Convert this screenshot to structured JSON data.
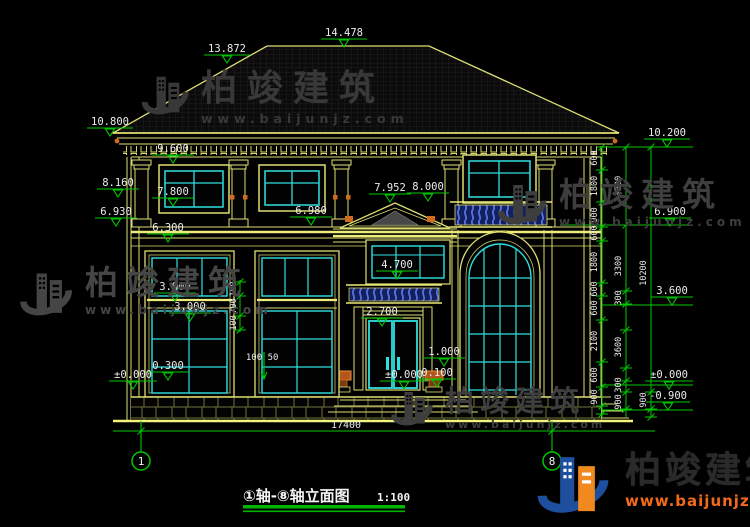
{
  "watermark": {
    "brand": "柏竣建筑",
    "url": "www.baijunjz.com"
  },
  "brand_logo": {
    "brand": "柏竣建筑",
    "url": "www.baijunjz.com"
  },
  "title_bar": {
    "title": "①轴-⑧轴立面图",
    "scale": "1:100"
  },
  "axes": {
    "left": "1",
    "right": "8"
  },
  "dims": {
    "total_width": "17400",
    "elevations": {
      "ridge": "14.478",
      "slope": "13.872",
      "eave": "10.800",
      "right_eave": "10.200",
      "win2_head": "9.600",
      "capital": "8.160",
      "balcony_rail": "8.000",
      "porch_ridge": "7.952",
      "win2_sill": "7.800",
      "eave_band_left": "6.930",
      "porch_eave": "6.980",
      "level2_right": "6.900",
      "floor_band": "6.300",
      "transom_head": "4.700",
      "win1_head": "3.900",
      "level1_right": "3.600",
      "transom_sill": "3.000",
      "door_head": "2.700",
      "planter": "1.000",
      "sill_ledge": "0.300",
      "entry_step": "0.100",
      "ground_left": "±0.000",
      "ground_entry": "±0.000",
      "ground_right": "±0.000",
      "footing": "-0.900"
    },
    "right_chain_inner": [
      "600",
      "1800",
      "900",
      "600",
      "1800",
      "600",
      "600",
      "2100",
      "600",
      "900"
    ],
    "right_chain_mid": [
      "3300",
      "3300",
      "300",
      "3600",
      "300",
      "900"
    ],
    "right_chain_outer": [
      "10200",
      "900"
    ],
    "pier_dims": [
      "100",
      "700",
      "100"
    ],
    "sill_dims": [
      "100",
      "50"
    ]
  },
  "colors": {
    "line_yellow": "#dede72",
    "window_cyan": "#2fe0e0",
    "dimension_green": "#00c800",
    "balustrade_blue": "#5873de",
    "accent_orange": "#cf6a1e",
    "logo_blue": "#1d4f9e",
    "logo_orange": "#f08a1e"
  }
}
